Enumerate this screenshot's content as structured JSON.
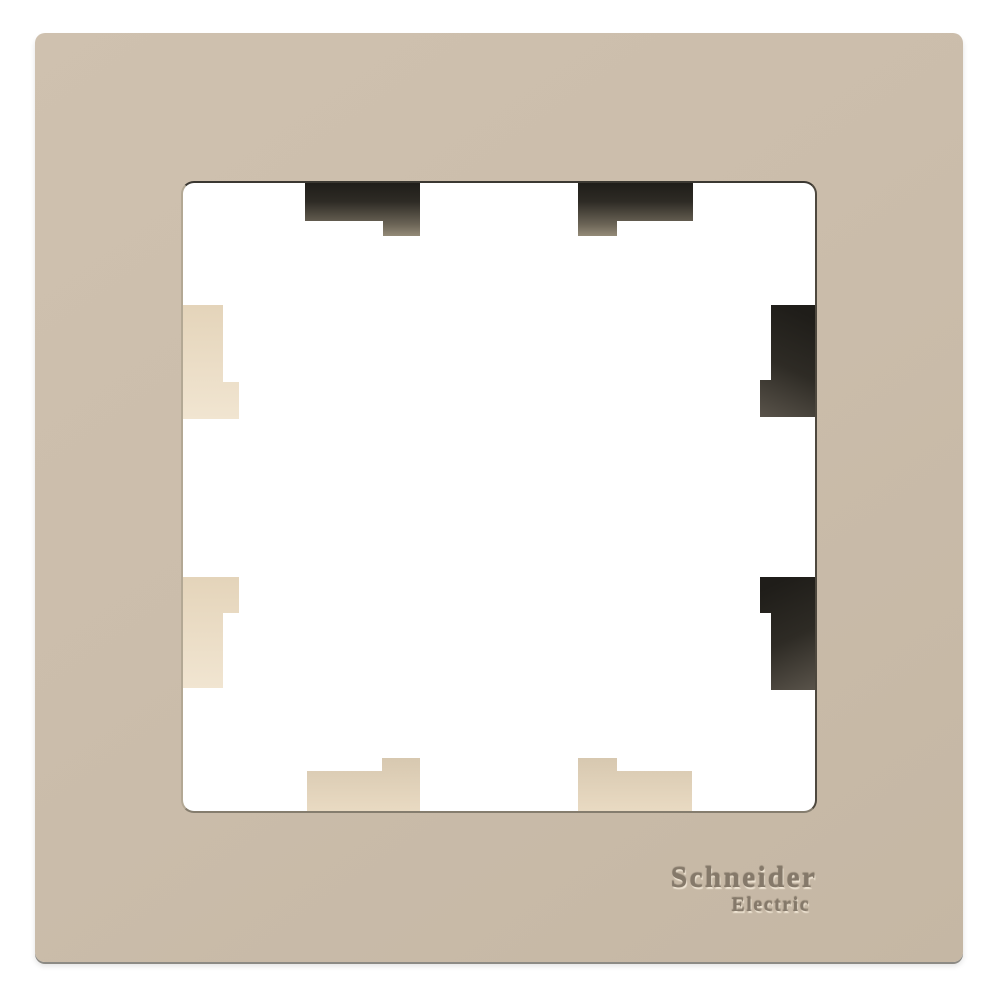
{
  "product": {
    "description": "Beige single-gang decorative wall switch frame, front view on white background",
    "logo_line1": "Schneider",
    "logo_line2": "Electric"
  },
  "parts": {
    "frame": "outer beige frame plate",
    "opening": "square central cutout",
    "mounting_tabs": [
      "tab-top-left",
      "tab-top-right",
      "tab-right-upper",
      "tab-right-lower",
      "tab-left-upper",
      "tab-left-lower",
      "tab-bottom-left",
      "tab-bottom-right"
    ]
  },
  "colors": {
    "background": "#ffffff",
    "frame_light": "#cfc1af",
    "frame_mid": "#cbbdab",
    "frame_dark": "#c5b7a4",
    "tab_dark_1": "#1f1d19",
    "tab_dark_2": "#2e2b25",
    "tab_dark_3": "#6b6456",
    "tab_dark_4": "#948b78",
    "tab_cream_1": "#e4d4ba",
    "tab_cream_2": "#f1e5d1",
    "tab_cream_dim_1": "#d7c8b0",
    "tab_cream_dim_2": "#e9dac2",
    "edge_top": "#3b3832",
    "edge_right": "#4e483e",
    "edge_bottom": "#857d6e",
    "edge_left": "#b3a894",
    "shadow_line": "#8c8a84",
    "logo_color": "#85796a",
    "logo_highlight": "#f4ead9",
    "logo_shadow": "#4a4235"
  }
}
